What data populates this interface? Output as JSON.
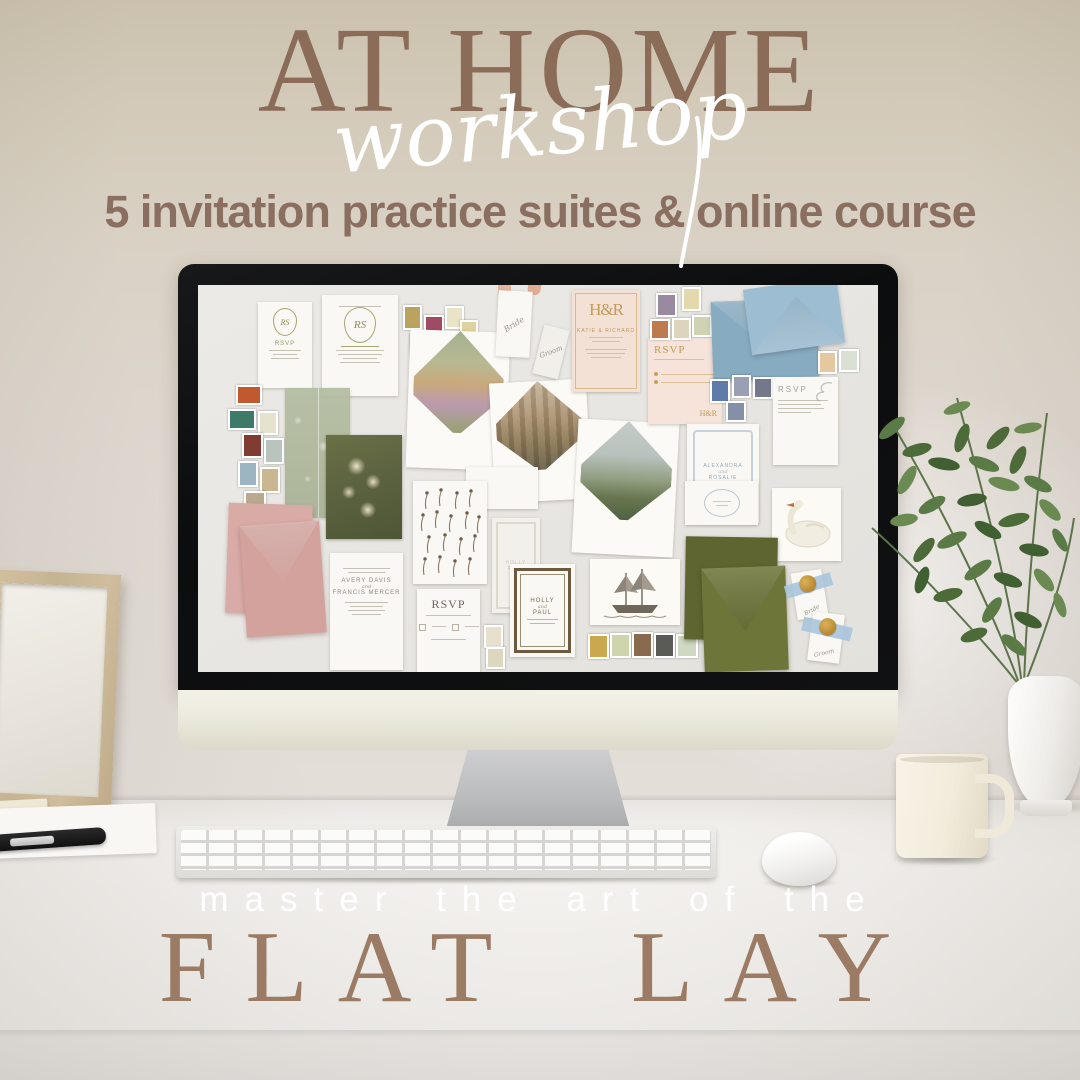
{
  "palette": {
    "title_brown": "#8a6c59",
    "subtitle_brown": "#8a6e60",
    "flatlay_brown": "#9c7b64",
    "script_white": "#ffffff",
    "wall_top": "#cbc1ae",
    "desk_white": "#f1efec",
    "blue_envelope": "#93b5ca",
    "pink_envelope": "#d6a8a3",
    "olive_envelope": "#6d7439",
    "blush_card": "#f4e1d6",
    "gold": "#bd9758"
  },
  "header": {
    "title": "AT HOME",
    "script": "workshop",
    "subtitle": "5 invitation practice suites & online course"
  },
  "footer": {
    "tagline": "master the art of the",
    "title": "FLAT LAY"
  },
  "moodboard": {
    "crest_monogram": "RS",
    "crest_rsvp": "RSVP",
    "invite_monogram": "RS",
    "bride_tag": "Bride",
    "groom_tag": "Groom",
    "hr_monogram": "H&R",
    "hr_names": "KATIE & RICHARD",
    "blush_rsvp": "RSVP",
    "blush_rsvp_monogram": "H&R",
    "flourish_rsvp": "RSVP",
    "alexandra": "ALEXANDRA",
    "alexandra_and": "and",
    "rosalie": "ROSALIE",
    "avery": "AVERY DAVIS",
    "avery_and": "and",
    "francis": "FRANCIS MERCER",
    "serif_rsvp": "RSVP",
    "holly": "HOLLY",
    "holly_and": "and",
    "paul": "PAUL",
    "seal_tag_bride": "Bride",
    "seal_tag_groom": "Groom"
  }
}
